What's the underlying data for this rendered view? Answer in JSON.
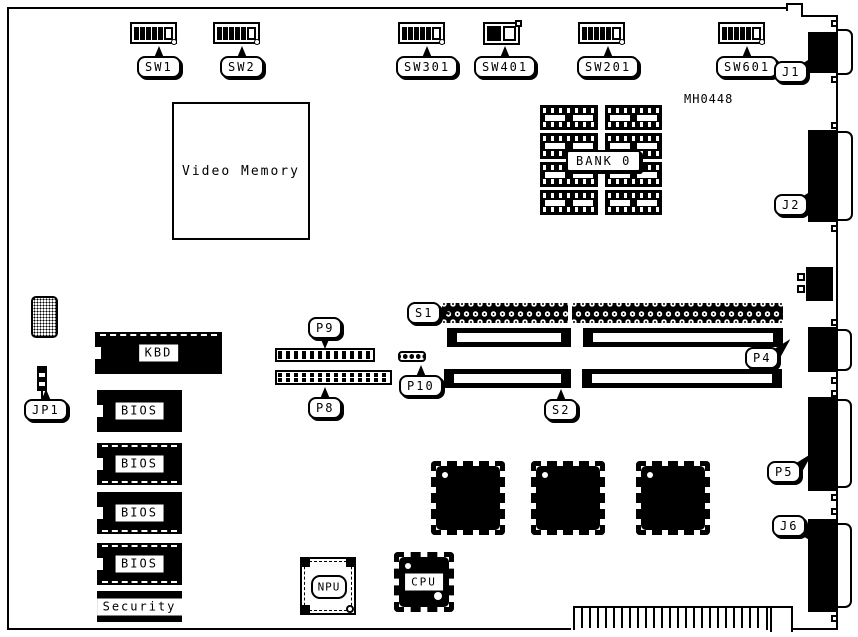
{
  "part_number": "MH0448",
  "switches": {
    "sw1": "SW1",
    "sw2": "SW2",
    "sw301": "SW301",
    "sw401": "SW401",
    "sw201": "SW201",
    "sw601": "SW601"
  },
  "rear_connectors": {
    "j1": "J1",
    "j2": "J2",
    "p4": "P4",
    "p5": "P5",
    "j6": "J6"
  },
  "headers": {
    "jp1": "JP1",
    "p8": "P8",
    "p9": "P9",
    "p10": "P10",
    "s1": "S1",
    "s2": "S2"
  },
  "chips": {
    "kbd": "KBD",
    "bios": "BIOS",
    "security": "Security",
    "npu": "NPU",
    "cpu": "CPU"
  },
  "memory": {
    "video": "Video Memory",
    "bank0": "BANK 0"
  },
  "colors": {
    "line": "#000000",
    "background": "#ffffff"
  }
}
